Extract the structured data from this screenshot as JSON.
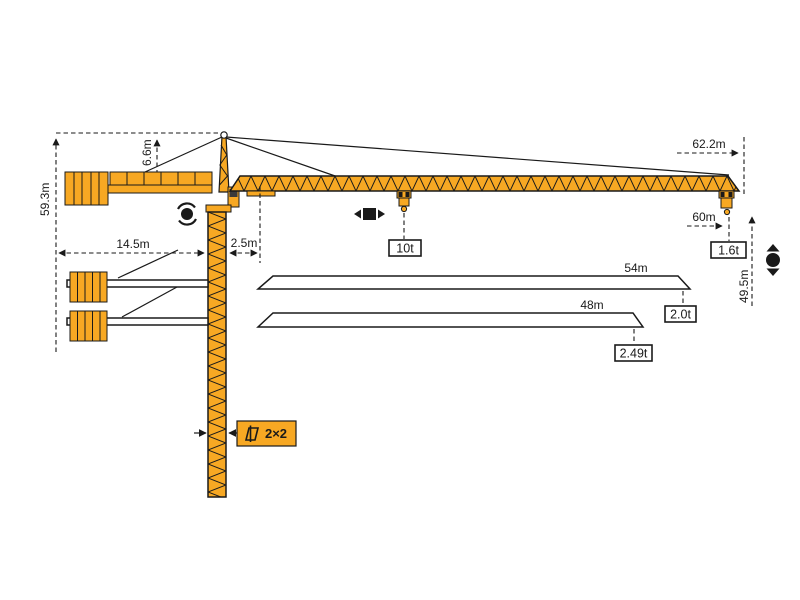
{
  "diagram_type": "tower crane specification diagram",
  "colors": {
    "crane_orange": "#F7A823",
    "outline_black": "#1A1A1A",
    "background": "#FFFFFF"
  },
  "dimensions": {
    "total_height": "59.3m",
    "tower_head_height": "6.6m",
    "counter_jib_length": "14.5m",
    "jib_root_offset": "2.5m",
    "max_jib_radius": "62.2m",
    "hook_radius": "60m",
    "hook_height": "49.5m",
    "mast_section": "2×2"
  },
  "loads": {
    "max_load": "10t",
    "tip_load_62m": "1.6t",
    "tip_load_54m": "2.0t",
    "tip_load_48m": "2.49t"
  },
  "jib_lengths": {
    "jib_54": "54m",
    "jib_48": "48m"
  },
  "icons": [
    {
      "name": "slewing-icon",
      "meaning": "slewing rotation"
    },
    {
      "name": "trolley-travel-icon",
      "meaning": "trolley travel"
    },
    {
      "name": "hoist-icon",
      "meaning": "hook hoist up/down"
    },
    {
      "name": "mast-section-icon",
      "meaning": "mast cross-section"
    }
  ]
}
